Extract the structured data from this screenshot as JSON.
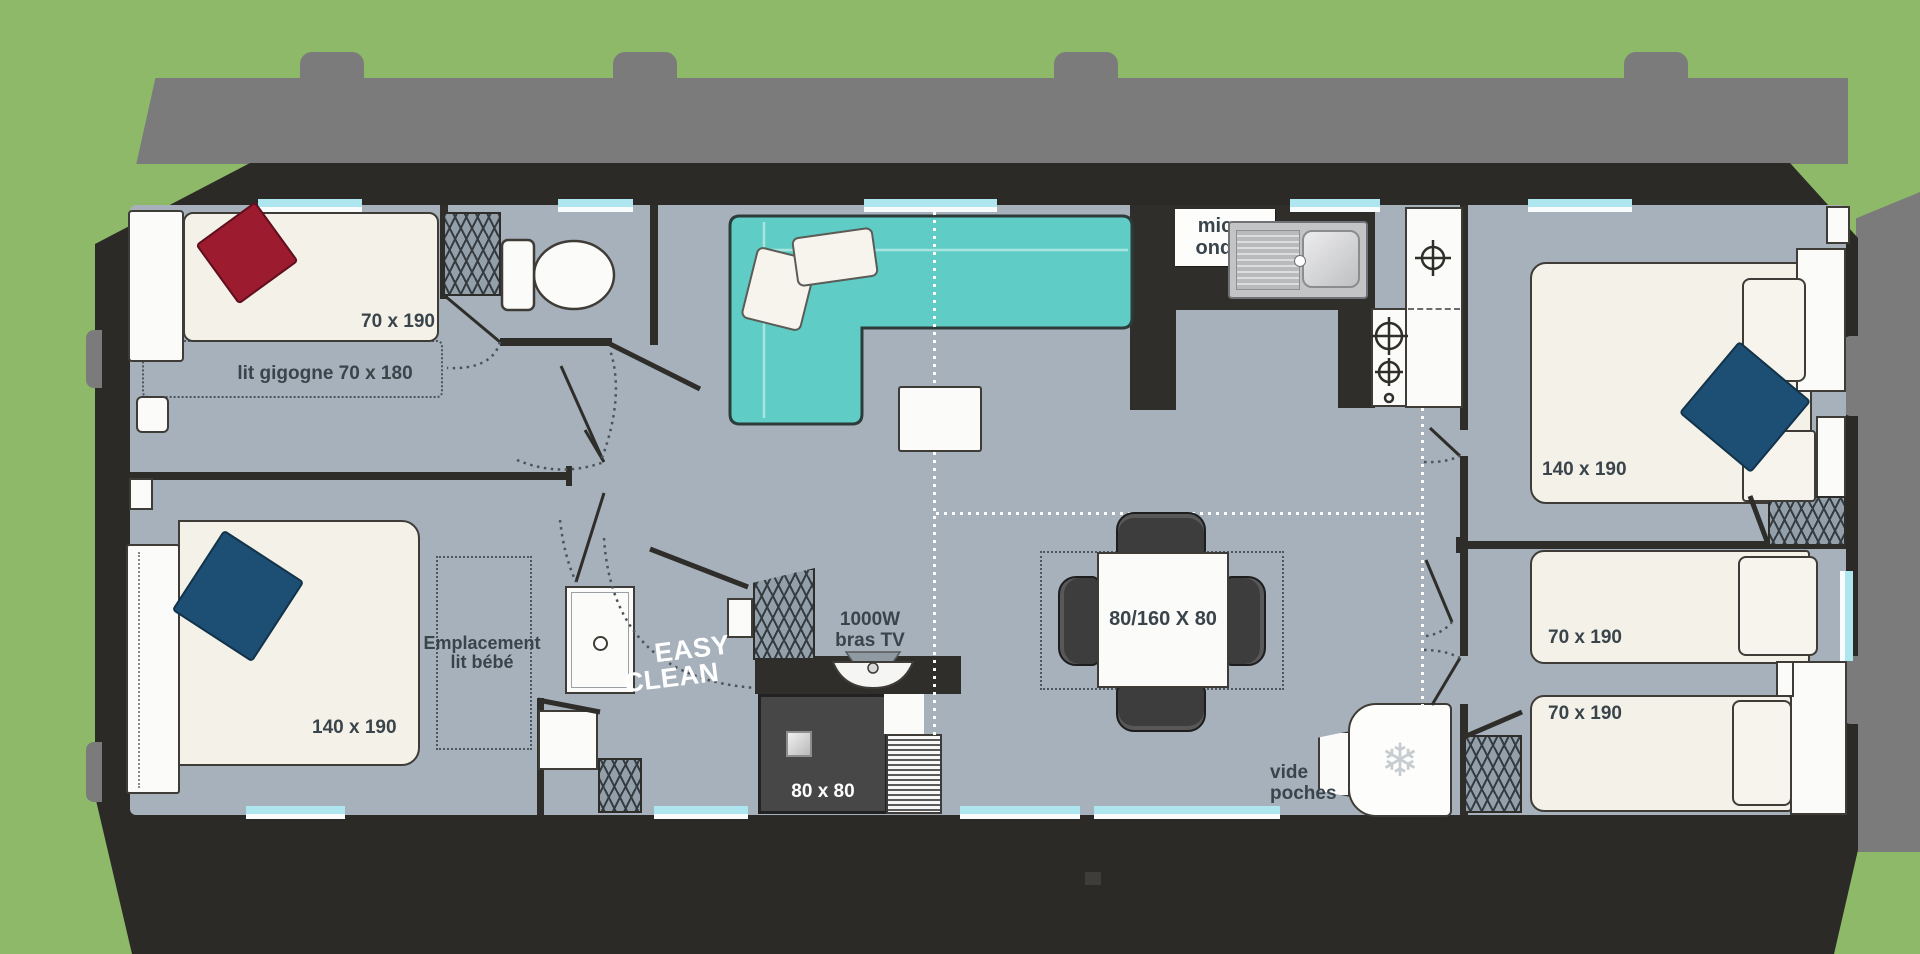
{
  "scene": {
    "type": "mobile-home floor plan, top view",
    "colors": {
      "grass": "#8db968",
      "deck": "#7b7b7c",
      "shell": "#2c2a27",
      "floor": "#a6b1bb",
      "sofa": "#5fcdc5",
      "window": "#aee6f0",
      "pillow_red": "#9c1b2e",
      "pillow_navy": "#1d4e74",
      "text_dark": "#3a444b",
      "mattress": "#f4f2e8",
      "shower_dark": "#474747"
    }
  },
  "labels": {
    "bed_top_left": "70 x 190",
    "trundle_bed": "lit gigogne 70 x 180",
    "bed_bottom_left": "140 x 190",
    "baby_line1": "Emplacement",
    "baby_line2": "lit bébé",
    "logo_line1": "EASY",
    "logo_line2": "CLEAN",
    "tv_line1": "1000W",
    "tv_line2": "bras TV",
    "shower": "80 x 80",
    "microwave_line1": "micro",
    "microwave_line2": "ondes",
    "dining_table": "80/160 X 80",
    "pockets_line1": "vide",
    "pockets_line2": "poches",
    "bed_top_right": "140 x 190",
    "bed_mid_right": "70 x 190",
    "bed_bottom_right": "70 x 190"
  },
  "icons": {
    "fridge_snowflake": "❄"
  }
}
